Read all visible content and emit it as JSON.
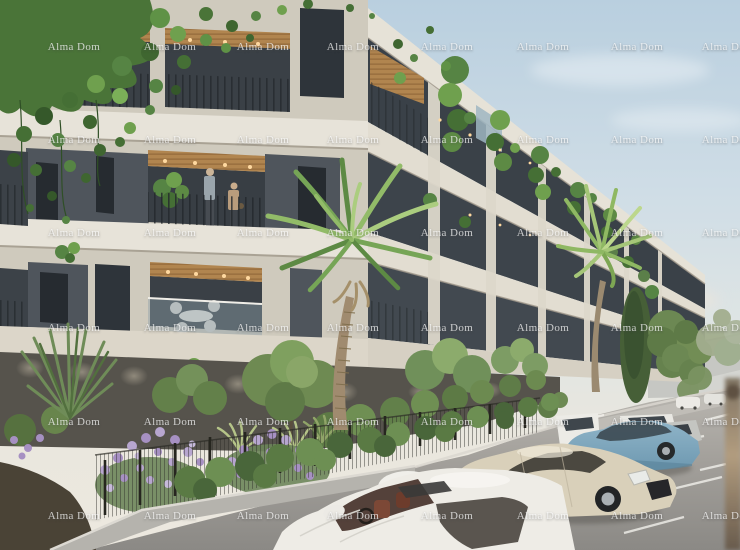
{
  "image": {
    "kind": "architectural-render",
    "subject": "Modern residential apartment building with balconies, rooftop greenery, palm trees, front garden and street parking",
    "width": 740,
    "height": 550
  },
  "watermark": {
    "text": "Alma Dom",
    "color": "rgba(255,255,255,0.72)",
    "font_size_px": 11,
    "columns_x": [
      74,
      170,
      263,
      353,
      447,
      543,
      637,
      728
    ],
    "rows_y": [
      47,
      140,
      233,
      328,
      422,
      516
    ]
  },
  "palette": {
    "sky_top": "#b9cfdf",
    "sky_horizon": "#ece8df",
    "facade_light": "#e6e2d7",
    "facade_cream": "#cfcabd",
    "panel_charcoal": "#4f555c",
    "window_glass": "#2e343a",
    "balcony_wood": "#b1854f",
    "base_wall": "#56534c",
    "fascia": "#dcd6c9",
    "asphalt": "#8b8985",
    "foliage_dark": "#456f35",
    "foliage_light": "#8ab55f",
    "lavender": "#b4a2cc",
    "hedge": "#5d7a45",
    "car_blue": "#7fa8bf",
    "car_cream": "#d9d0ba",
    "car_white": "#edece7",
    "distant_building": "#c6c7c3"
  },
  "scene": {
    "sky": "pale blue sky fading to warm haze at the horizon",
    "building": "six-storey modern apartment block seen from its corner; cream facade, charcoal window panels, wood balcony ceilings with spot lights, metal and glass railings, cascading plants, ivy over the roof edge",
    "people": "two residents standing on a second-floor corner balcony",
    "landscaping": "lavender and shrub garden behind a black metal fence, two palm trees, cypress and leafy trees along the street",
    "street": "parking lane with white bay markings; white, champagne, light-blue and silver cars parked; small cars and a grey building in the distance"
  }
}
